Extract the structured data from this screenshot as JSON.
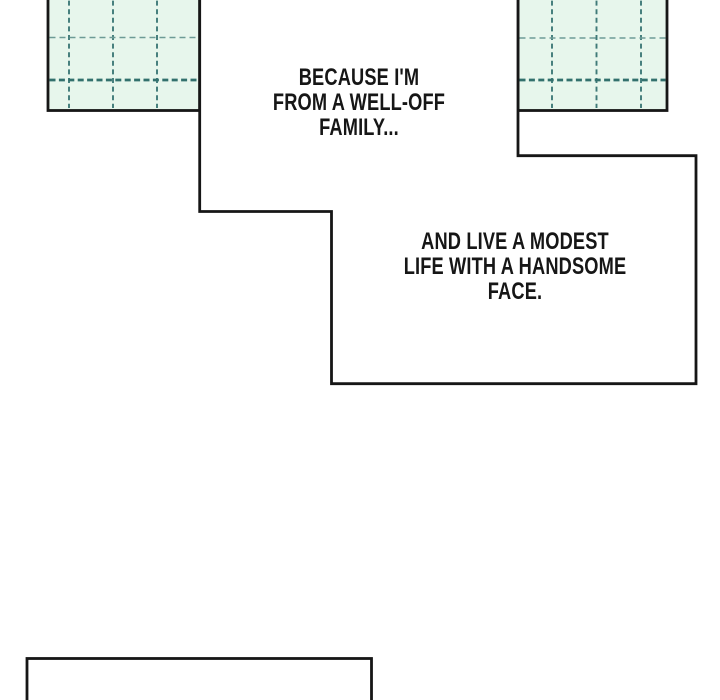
{
  "colors": {
    "paper": "#ffffff",
    "ink": "#161616",
    "window_fill": "#e7f6ec",
    "grid_light": "#6e9b96",
    "grid_mid": "#3f7a78",
    "grid_dark": "#32706d"
  },
  "speech": {
    "bubble_a": {
      "lines": [
        "BECAUSE I'M",
        "FROM A WELL-OFF",
        "FAMILY..."
      ]
    },
    "bubble_b": {
      "lines": [
        "AND LIVE A MODEST",
        "LIFE WITH A HANDSOME",
        "FACE."
      ]
    }
  }
}
